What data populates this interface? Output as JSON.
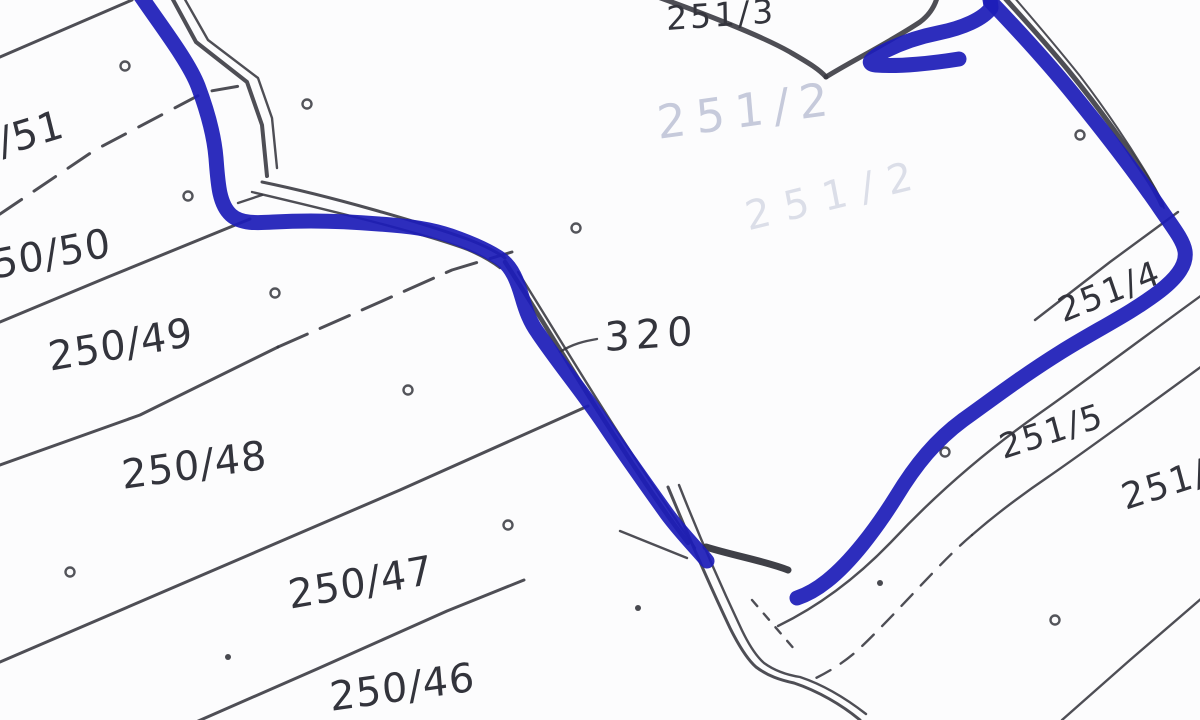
{
  "map": {
    "type": "cadastral-parcel-sketch",
    "width": 1200,
    "height": 720,
    "background": "#fcfcfd",
    "ink_color": "#35363d",
    "marker_color": "#1d1db8",
    "labels": [
      {
        "name": "parcel-label-251-3",
        "text": "251/3",
        "x": 666,
        "y": 2,
        "rot": -4,
        "size": 33,
        "ls": 3
      },
      {
        "name": "parcel-label-250-51",
        "text": "/51",
        "x": -6,
        "y": 124,
        "rot": -17,
        "size": 40,
        "ls": 1
      },
      {
        "name": "parcel-label-250-50",
        "text": "50/50",
        "x": -10,
        "y": 246,
        "rot": -11,
        "size": 40,
        "ls": 1
      },
      {
        "name": "parcel-label-250-49",
        "text": "250/49",
        "x": 46,
        "y": 338,
        "rot": -10,
        "size": 40,
        "ls": 1
      },
      {
        "name": "parcel-label-250-48",
        "text": "250/48",
        "x": 120,
        "y": 456,
        "rot": -8,
        "size": 40,
        "ls": 1
      },
      {
        "name": "parcel-label-250-47",
        "text": "250/47",
        "x": 286,
        "y": 576,
        "rot": -10,
        "size": 40,
        "ls": 1
      },
      {
        "name": "parcel-label-250-46",
        "text": "250/46",
        "x": 328,
        "y": 678,
        "rot": -8,
        "size": 40,
        "ls": 1
      },
      {
        "name": "parcel-label-320",
        "text": "320",
        "x": 604,
        "y": 318,
        "rot": -4,
        "size": 40,
        "ls": 6
      },
      {
        "name": "parcel-label-251-4",
        "text": "251/4",
        "x": 1054,
        "y": 296,
        "rot": -22,
        "size": 34,
        "ls": 2
      },
      {
        "name": "parcel-label-251-5",
        "text": "251/5",
        "x": 996,
        "y": 432,
        "rot": -18,
        "size": 34,
        "ls": 2
      },
      {
        "name": "parcel-label-251-cut",
        "text": "251/",
        "x": 1118,
        "y": 482,
        "rot": -18,
        "size": 36,
        "ls": 2
      },
      {
        "name": "parcel-label-faint-251-2",
        "text": "251/2",
        "x": 655,
        "y": 100,
        "rot": -8,
        "size": 46,
        "ls": 10,
        "faint": true,
        "opacity": 0.75
      },
      {
        "name": "parcel-label-faint-lower",
        "text": "251/2",
        "x": 742,
        "y": 198,
        "rot": -14,
        "size": 40,
        "ls": 14,
        "faint": true,
        "opacity": 0.45
      }
    ],
    "linework": [
      {
        "name": "strip-line-1",
        "d": "M 0 57 L 132 0",
        "w": 3
      },
      {
        "name": "strip-line-2",
        "d": "M 0 214 L 95 150 L 205 92 L 240 86",
        "w": 3,
        "dash": "26 15"
      },
      {
        "name": "strip-line-3",
        "d": "M 0 322 L 108 277 L 250 219",
        "w": 3
      },
      {
        "name": "strip-line-4a",
        "d": "M 0 465 L 140 415 L 278 347",
        "w": 3
      },
      {
        "name": "strip-line-4b",
        "d": "M 278 347 L 380 302 L 452 270 L 512 252",
        "w": 3,
        "dash": "32 14"
      },
      {
        "name": "strip-line-5",
        "d": "M 0 662 L 200 576 L 400 490 L 588 406",
        "w": 3
      },
      {
        "name": "strip-line-6",
        "d": "M 196 722 L 317 669 L 447 611 L 524 580",
        "w": 3
      },
      {
        "name": "lane-top-outer",
        "d": "M 171 -4 L 196 42 L 247 82 L 262 125 L 267 176",
        "w": 4
      },
      {
        "name": "lane-top-inner",
        "d": "M 183 -4 L 208 40 L 258 78 L 272 118 L 277 168",
        "w": 2.4
      },
      {
        "name": "lane-mid-upper",
        "d": "M 262 182 C 330 196 420 222 470 240 C 485 246 497 252 505 258",
        "w": 3
      },
      {
        "name": "lane-mid-lower",
        "d": "M 252 192 C 320 208 420 232 468 250 C 482 256 492 262 500 268",
        "w": 2.4
      },
      {
        "name": "bend-scratch",
        "d": "M 238 203 L 262 195",
        "w": 2.4
      },
      {
        "name": "center-boundary-heavy",
        "d": "M 505 262 C 530 300 560 350 590 398 C 620 445 655 500 688 543",
        "w": 4.5
      },
      {
        "name": "center-boundary-thin",
        "d": "M 518 272 C 545 315 575 365 605 412 C 632 455 668 508 695 548",
        "w": 2.4
      },
      {
        "name": "junction-blob",
        "d": "M 706 547 C 735 556 765 561 788 570",
        "w": 7,
        "opacity": 0.95
      },
      {
        "name": "edge-below-320",
        "d": "M 620 531 L 687 558",
        "w": 2.4
      },
      {
        "name": "track-vert-outer",
        "d": "M 668 487 C 690 540 712 590 730 628 C 740 648 748 660 756 667 C 768 676 780 680 794 683 C 818 691 842 705 860 720",
        "w": 3
      },
      {
        "name": "track-vert-inner",
        "d": "M 679 485 C 700 538 722 588 739 624 C 748 644 756 656 764 663 C 775 671 787 675 800 677 C 824 685 848 700 866 714",
        "w": 2.4
      },
      {
        "name": "track-vert-dashes",
        "d": "M 752 600 L 795 650",
        "w": 2.4,
        "dash": "8 10"
      },
      {
        "name": "v-boundary-left",
        "d": "M 655 -4 C 700 12 760 35 790 52 C 805 61 818 68 826 77",
        "w": 5
      },
      {
        "name": "v-boundary-right",
        "d": "M 826 77 C 850 62 890 42 920 22 C 928 16 934 8 937 -2",
        "w": 5
      },
      {
        "name": "ne-boundary-heavy",
        "d": "M 1003 -4 C 1020 15 1045 42 1068 70 C 1095 103 1122 140 1143 172 C 1152 185 1158 196 1162 205",
        "w": 5
      },
      {
        "name": "ne-boundary-thin",
        "d": "M 1013 -4 C 1032 18 1056 46 1080 76 C 1106 110 1130 146 1148 176 C 1155 188 1160 198 1164 208",
        "w": 2
      },
      {
        "name": "right-strip-line-a",
        "d": "M 1035 320 L 1110 262 L 1178 212",
        "w": 2.4
      },
      {
        "name": "right-strip-line-b",
        "d": "M 1202 295 C 1140 340 1080 385 1040 413 C 990 448 940 490 893 540 C 855 580 815 608 778 626",
        "w": 2.4
      },
      {
        "name": "right-strip-line-c1",
        "d": "M 1202 366 C 1150 404 1090 448 1048 477 C 1020 496 995 515 972 535",
        "w": 2.4
      },
      {
        "name": "right-strip-line-c2",
        "d": "M 972 535 C 940 562 900 610 858 650 C 842 664 828 672 816 678",
        "w": 2.4,
        "dash": "16 12"
      },
      {
        "name": "right-strip-line-d",
        "d": "M 1202 598 L 1130 660 L 1062 720",
        "w": 2.4
      },
      {
        "name": "tick-320",
        "d": "M 560 352 C 572 344 585 341 597 339",
        "w": 2.4
      }
    ],
    "circle_markers": [
      {
        "x": 125,
        "y": 66
      },
      {
        "x": 307,
        "y": 104
      },
      {
        "x": 188,
        "y": 196
      },
      {
        "x": 576,
        "y": 228
      },
      {
        "x": 275,
        "y": 293
      },
      {
        "x": 408,
        "y": 390
      },
      {
        "x": 508,
        "y": 525
      },
      {
        "x": 70,
        "y": 572
      },
      {
        "x": 945,
        "y": 452
      },
      {
        "x": 1055,
        "y": 620
      },
      {
        "x": 1080,
        "y": 135
      }
    ],
    "dot_markers": [
      {
        "x": 228,
        "y": 657
      },
      {
        "x": 880,
        "y": 583
      },
      {
        "x": 638,
        "y": 608
      }
    ],
    "marker_paths": [
      {
        "name": "blue-marker-left-branch",
        "d": "M 138 -8 C 158 22 188 60 198 86 C 207 110 214 134 216 158 C 218 184 219 204 231 215 C 241 224 257 223 274 222 C 308 220 344 221 379 224 C 409 226 431 229 451 236 C 471 243 491 252 502 260 C 512 268 517 280 522 297 C 526 311 530 322 538 333 C 559 364 584 394 604 424 C 624 454 647 486 667 514 C 681 533 699 551 707 561"
      },
      {
        "name": "blue-marker-check-curl",
        "d": "M 989 -6 C 990 0 991 4 991 8 C 983 19 963 28 938 33 C 913 38 894 46 879 54 C 869 60 867 64 876 65 C 899 67 934 63 959 59"
      },
      {
        "name": "blue-marker-right-branch",
        "d": "M 991 2 C 1014 26 1044 58 1074 95 C 1104 132 1134 171 1157 204 C 1171 225 1183 239 1185 251 C 1187 264 1178 277 1160 291 C 1130 314 1096 330 1061 352 C 1021 377 991 400 963 420 C 936 440 916 464 896 497 C 876 529 851 562 827 581 C 817 589 806 595 797 598"
      }
    ]
  }
}
